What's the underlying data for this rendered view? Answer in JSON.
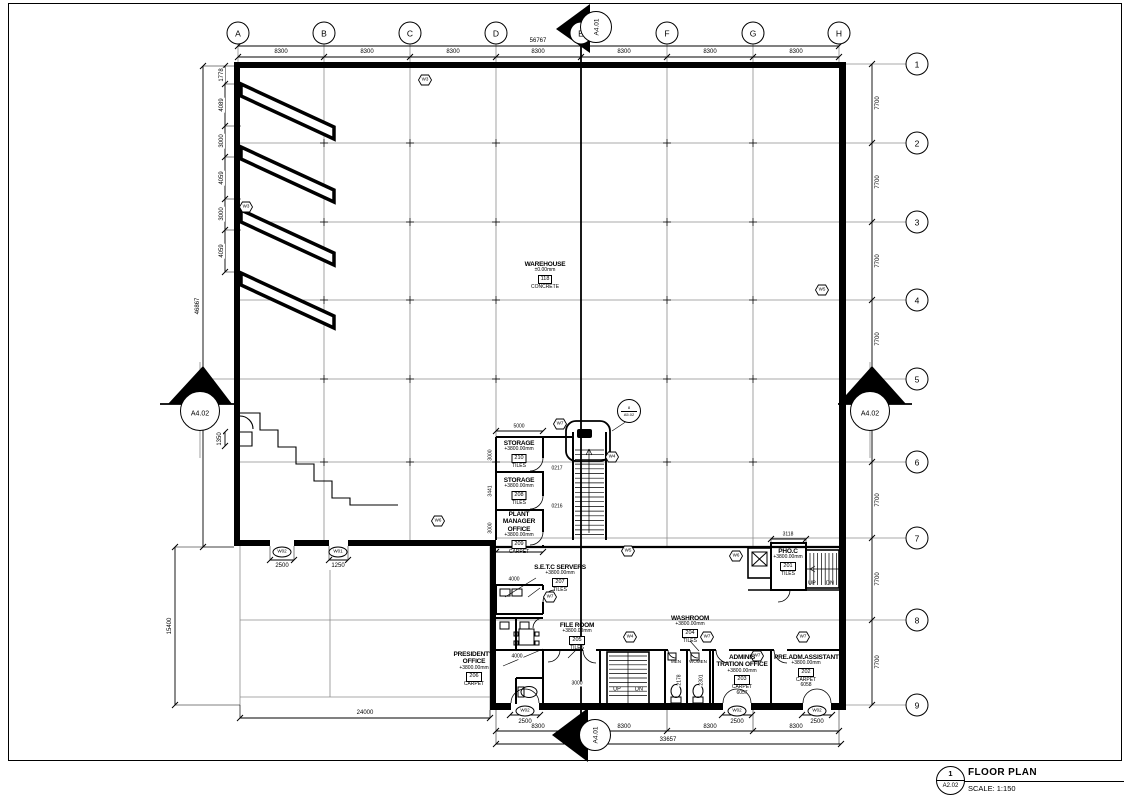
{
  "meta": {
    "number": "1",
    "sheet": "A2.02",
    "title": "FLOOR PLAN",
    "scale_label": "SCALE: 1:150"
  },
  "sections": {
    "a401": "A4.01",
    "a402": "A4.02",
    "callout_top": "8",
    "callout_bottom": "A5.02"
  },
  "labels": {
    "men": "MEN",
    "women": "WOMEN",
    "up": "UP",
    "dn": "DN"
  },
  "grid": {
    "cols": [
      {
        "label": "A",
        "x": 238,
        "y": 33
      },
      {
        "label": "B",
        "x": 324,
        "y": 33
      },
      {
        "label": "C",
        "x": 410,
        "y": 33
      },
      {
        "label": "D",
        "x": 496,
        "y": 33
      },
      {
        "label": "E",
        "x": 581,
        "y": 33
      },
      {
        "label": "F",
        "x": 667,
        "y": 33
      },
      {
        "label": "G",
        "x": 753,
        "y": 33
      },
      {
        "label": "H",
        "x": 839,
        "y": 33
      }
    ],
    "rows": [
      {
        "label": "1",
        "x": 917,
        "y": 64
      },
      {
        "label": "2",
        "x": 917,
        "y": 143
      },
      {
        "label": "3",
        "x": 917,
        "y": 222
      },
      {
        "label": "4",
        "x": 917,
        "y": 300
      },
      {
        "label": "5",
        "x": 917,
        "y": 379
      },
      {
        "label": "6",
        "x": 917,
        "y": 462
      },
      {
        "label": "7",
        "x": 917,
        "y": 538
      },
      {
        "label": "8",
        "x": 917,
        "y": 620
      },
      {
        "label": "9",
        "x": 917,
        "y": 705
      }
    ]
  },
  "dims": {
    "top": [
      {
        "label": "8300",
        "x": 281,
        "y": 52
      },
      {
        "label": "8300",
        "x": 367,
        "y": 52
      },
      {
        "label": "8300",
        "x": 453,
        "y": 52
      },
      {
        "label": "8300",
        "x": 538,
        "y": 52
      },
      {
        "label": "8300",
        "x": 624,
        "y": 52
      },
      {
        "label": "8300",
        "x": 710,
        "y": 52
      },
      {
        "label": "8300",
        "x": 796,
        "y": 52
      },
      {
        "label": "56767",
        "x": 538,
        "y": 41
      }
    ],
    "right": [
      {
        "label": "7700",
        "x": 878,
        "y": 103,
        "rot": 1
      },
      {
        "label": "7700",
        "x": 878,
        "y": 182,
        "rot": 1
      },
      {
        "label": "7700",
        "x": 878,
        "y": 261,
        "rot": 1
      },
      {
        "label": "7700",
        "x": 878,
        "y": 339,
        "rot": 1
      },
      {
        "label": "7700",
        "x": 878,
        "y": 420,
        "rot": 1
      },
      {
        "label": "7700",
        "x": 878,
        "y": 500,
        "rot": 1
      },
      {
        "label": "7700",
        "x": 878,
        "y": 579,
        "rot": 1
      },
      {
        "label": "7700",
        "x": 878,
        "y": 662,
        "rot": 1
      }
    ],
    "left": [
      {
        "label": "1778",
        "x": 222,
        "y": 75,
        "rot": 1
      },
      {
        "label": "4089",
        "x": 222,
        "y": 105,
        "rot": 1
      },
      {
        "label": "3000",
        "x": 222,
        "y": 141,
        "rot": 1
      },
      {
        "label": "4059",
        "x": 222,
        "y": 178,
        "rot": 1
      },
      {
        "label": "3000",
        "x": 222,
        "y": 214,
        "rot": 1
      },
      {
        "label": "4059",
        "x": 222,
        "y": 251,
        "rot": 1
      },
      {
        "label": "46867",
        "x": 198,
        "y": 306,
        "rot": 1
      },
      {
        "label": "1350",
        "x": 220,
        "y": 439,
        "rot": 1
      },
      {
        "label": "15400",
        "x": 170,
        "y": 626,
        "rot": 1
      }
    ],
    "bottom": [
      {
        "label": "24000",
        "x": 365,
        "y": 713
      },
      {
        "label": "2500",
        "x": 282,
        "y": 566
      },
      {
        "label": "1250",
        "x": 338,
        "y": 566
      },
      {
        "label": "2500",
        "x": 525,
        "y": 722
      },
      {
        "label": "2500",
        "x": 737,
        "y": 722
      },
      {
        "label": "2500",
        "x": 817,
        "y": 722
      },
      {
        "label": "8300",
        "x": 538,
        "y": 727
      },
      {
        "label": "8300",
        "x": 624,
        "y": 727
      },
      {
        "label": "8300",
        "x": 710,
        "y": 727
      },
      {
        "label": "8300",
        "x": 796,
        "y": 727
      },
      {
        "label": "33657",
        "x": 668,
        "y": 740
      }
    ],
    "small": [
      {
        "label": "5000",
        "x": 519,
        "y": 427
      },
      {
        "label": "5000",
        "x": 519,
        "y": 548
      },
      {
        "label": "3000",
        "x": 491,
        "y": 455,
        "rot": 1
      },
      {
        "label": "3441",
        "x": 491,
        "y": 491,
        "rot": 1
      },
      {
        "label": "3000",
        "x": 491,
        "y": 528,
        "rot": 1
      },
      {
        "label": "4000",
        "x": 514,
        "y": 580
      },
      {
        "label": "4000",
        "x": 517,
        "y": 657
      },
      {
        "label": "3000",
        "x": 577,
        "y": 684
      },
      {
        "label": "3118",
        "x": 788,
        "y": 535
      },
      {
        "label": "2178",
        "x": 680,
        "y": 680,
        "rot": 1
      },
      {
        "label": "2301",
        "x": 702,
        "y": 680,
        "rot": 1
      },
      {
        "label": "0217",
        "x": 557,
        "y": 469
      },
      {
        "label": "0216",
        "x": 557,
        "y": 507
      }
    ]
  },
  "door_tags": [
    {
      "label": "W02",
      "x": 282,
      "y": 552
    },
    {
      "label": "W01",
      "x": 338,
      "y": 552
    },
    {
      "label": "W02",
      "x": 525,
      "y": 711
    },
    {
      "label": "W02",
      "x": 737,
      "y": 711
    },
    {
      "label": "W02",
      "x": 817,
      "y": 711
    }
  ],
  "wall_markers": [
    {
      "label": "W3",
      "x": 425,
      "y": 80
    },
    {
      "label": "W3",
      "x": 246,
      "y": 207
    },
    {
      "label": "W5",
      "x": 822,
      "y": 290
    },
    {
      "label": "W6",
      "x": 438,
      "y": 521
    },
    {
      "label": "W7",
      "x": 560,
      "y": 424
    },
    {
      "label": "W4",
      "x": 612,
      "y": 457
    },
    {
      "label": "W7",
      "x": 550,
      "y": 597
    },
    {
      "label": "W5",
      "x": 628,
      "y": 551
    },
    {
      "label": "W6",
      "x": 736,
      "y": 556
    },
    {
      "label": "W4",
      "x": 630,
      "y": 637
    },
    {
      "label": "W7",
      "x": 707,
      "y": 637
    },
    {
      "label": "W7",
      "x": 757,
      "y": 656
    },
    {
      "label": "W7",
      "x": 803,
      "y": 637
    }
  ],
  "xmarks": [
    {
      "label": "3",
      "x": 590,
      "y": 19
    },
    {
      "label": "x",
      "x": 578,
      "y": 736
    },
    {
      "label": "3",
      "x": 201,
      "y": 398
    },
    {
      "label": "x",
      "x": 870,
      "y": 398
    }
  ],
  "rooms": {
    "warehouse": {
      "name": "WAREHOUSE",
      "elev": "±0.00mm",
      "num": "118",
      "finish": "CONCRETE"
    },
    "s210": {
      "name": "STORAGE",
      "elev": "+3800.00mm",
      "num": "210",
      "finish": "TILES"
    },
    "s208": {
      "name": "STORAGE",
      "elev": "+3800.00mm",
      "num": "208",
      "finish": "TILES"
    },
    "pmo209": {
      "name": "PLANT MANAGER OFFICE",
      "elev": "+3800.00mm",
      "num": "209",
      "finish": "CARPET"
    },
    "setc207": {
      "name": "S.E.T.C SERVERS",
      "elev": "+3800.00mm",
      "num": "207",
      "finish": "TILES"
    },
    "file205": {
      "name": "FILE ROOM",
      "elev": "+3800.00mm",
      "num": "205",
      "finish": "TILES"
    },
    "pres206": {
      "name": "PRESIDENT'S OFFICE",
      "elev": "+3800.00mm",
      "num": "206",
      "finish": "CARPET"
    },
    "wash204": {
      "name": "WASHROOM",
      "elev": "+3800.00mm",
      "num": "204",
      "finish": "TILES"
    },
    "admin203": {
      "name": "ADMINIS TRATION OFFICE",
      "elev": "+3800.00mm",
      "num": "203",
      "finish": "CARPET",
      "extra": "6057"
    },
    "preadm202": {
      "name": "PRE.ADM.ASSISTANT",
      "elev": "+3800.00mm",
      "num": "202",
      "finish": "CARPET",
      "extra": "6058"
    },
    "phoc201": {
      "name": "PHO.C",
      "elev": "+3800.00mm",
      "num": "201",
      "finish": "TILES"
    }
  }
}
